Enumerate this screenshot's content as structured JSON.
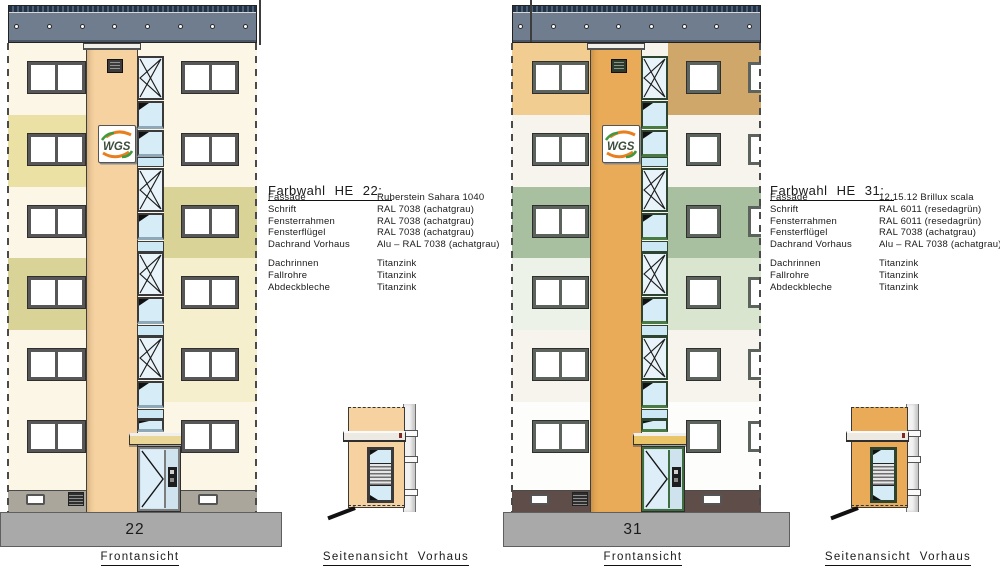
{
  "drawing": {
    "logo_text": "WGS",
    "buildings": [
      {
        "number": "22",
        "front_label": "Frontansicht",
        "side_label": "Seitenansicht  Vorhaus",
        "colors": {
          "base": "#fbf6e6",
          "bands_left": [
            "#fbf6e6",
            "#ebe1a5",
            "#fbf6e6",
            "#d9d398",
            "#fbf6e6",
            "#fbf6e6"
          ],
          "bands_right": [
            "#fbf6e6",
            "#fbf6e6",
            "#d9d398",
            "#f5efcd",
            "#f5efcd",
            "#fbf6e6"
          ],
          "tower": "#f6d2a0",
          "cap": "#f1efe9",
          "vent": "#3c3c3c",
          "strip_frame": "#3a3a3a",
          "accent": "#8fa8b8",
          "window_frame": "#575757",
          "plinth": "#aba69b",
          "canopy": "#ead797",
          "door_frame": "#7c7c7c",
          "roof": "#6f7d8e",
          "roof_hatch": "#243246",
          "ground": "#a9a9a9"
        }
      },
      {
        "number": "31",
        "front_label": "Frontansicht",
        "side_label": "Seitenansicht  Vorhaus",
        "colors": {
          "base": "#f7f4ee",
          "bands_left": [
            "#f1cd92",
            "#f7f4ee",
            "#a8c09f",
            "#edf2e8",
            "#f7f4ee",
            "#fdfdfb"
          ],
          "bands_right": [
            "#cfa76b",
            "#f7f4ee",
            "#a8c09f",
            "#d9e5cf",
            "#f7f4ee",
            "#fdfdfb"
          ],
          "tower": "#e9ab57",
          "cap": "#f1efe9",
          "vent": "#2c3c2c",
          "strip_frame": "#2c4430",
          "accent": "#4a7a43",
          "window_frame": "#5c635c",
          "plinth": "#5f4d49",
          "canopy": "#e9c568",
          "door_frame": "#3f6f3f",
          "roof": "#6f7d8e",
          "roof_hatch": "#243246",
          "ground": "#a9a9a9"
        }
      }
    ]
  },
  "spec_blocks": [
    {
      "title": "Farbwahl HE 22:",
      "rows": [
        [
          "Fassade",
          "Ruberstein Sahara 1040"
        ],
        [
          "Schrift",
          "RAL 7038 (achatgrau)"
        ],
        [
          "Fensterrahmen",
          "RAL 7038 (achatgrau)"
        ],
        [
          "Fensterflügel",
          "RAL 7038 (achatgrau)"
        ],
        [
          "Dachrand Vorhaus",
          "Alu – RAL 7038 (achatgrau)"
        ]
      ],
      "rows2": [
        [
          "Dachrinnen",
          "Titanzink"
        ],
        [
          "Fallrohre",
          "Titanzink"
        ],
        [
          "Abdeckbleche",
          "Titanzink"
        ]
      ]
    },
    {
      "title": "Farbwahl HE 31:",
      "rows": [
        [
          "Fassade",
          "12.15.12 Brillux scala"
        ],
        [
          "Schrift",
          "RAL 6011 (resedagrün)"
        ],
        [
          "Fensterrahmen",
          "RAL 6011 (resedagrün)"
        ],
        [
          "Fensterflügel",
          "RAL 7038 (achatgrau)"
        ],
        [
          "Dachrand Vorhaus",
          "Alu – RAL 7038 (achatgrau)"
        ]
      ],
      "rows2": [
        [
          "Dachrinnen",
          "Titanzink"
        ],
        [
          "Fallrohre",
          "Titanzink"
        ],
        [
          "Abdeckbleche",
          "Titanzink"
        ]
      ]
    }
  ]
}
